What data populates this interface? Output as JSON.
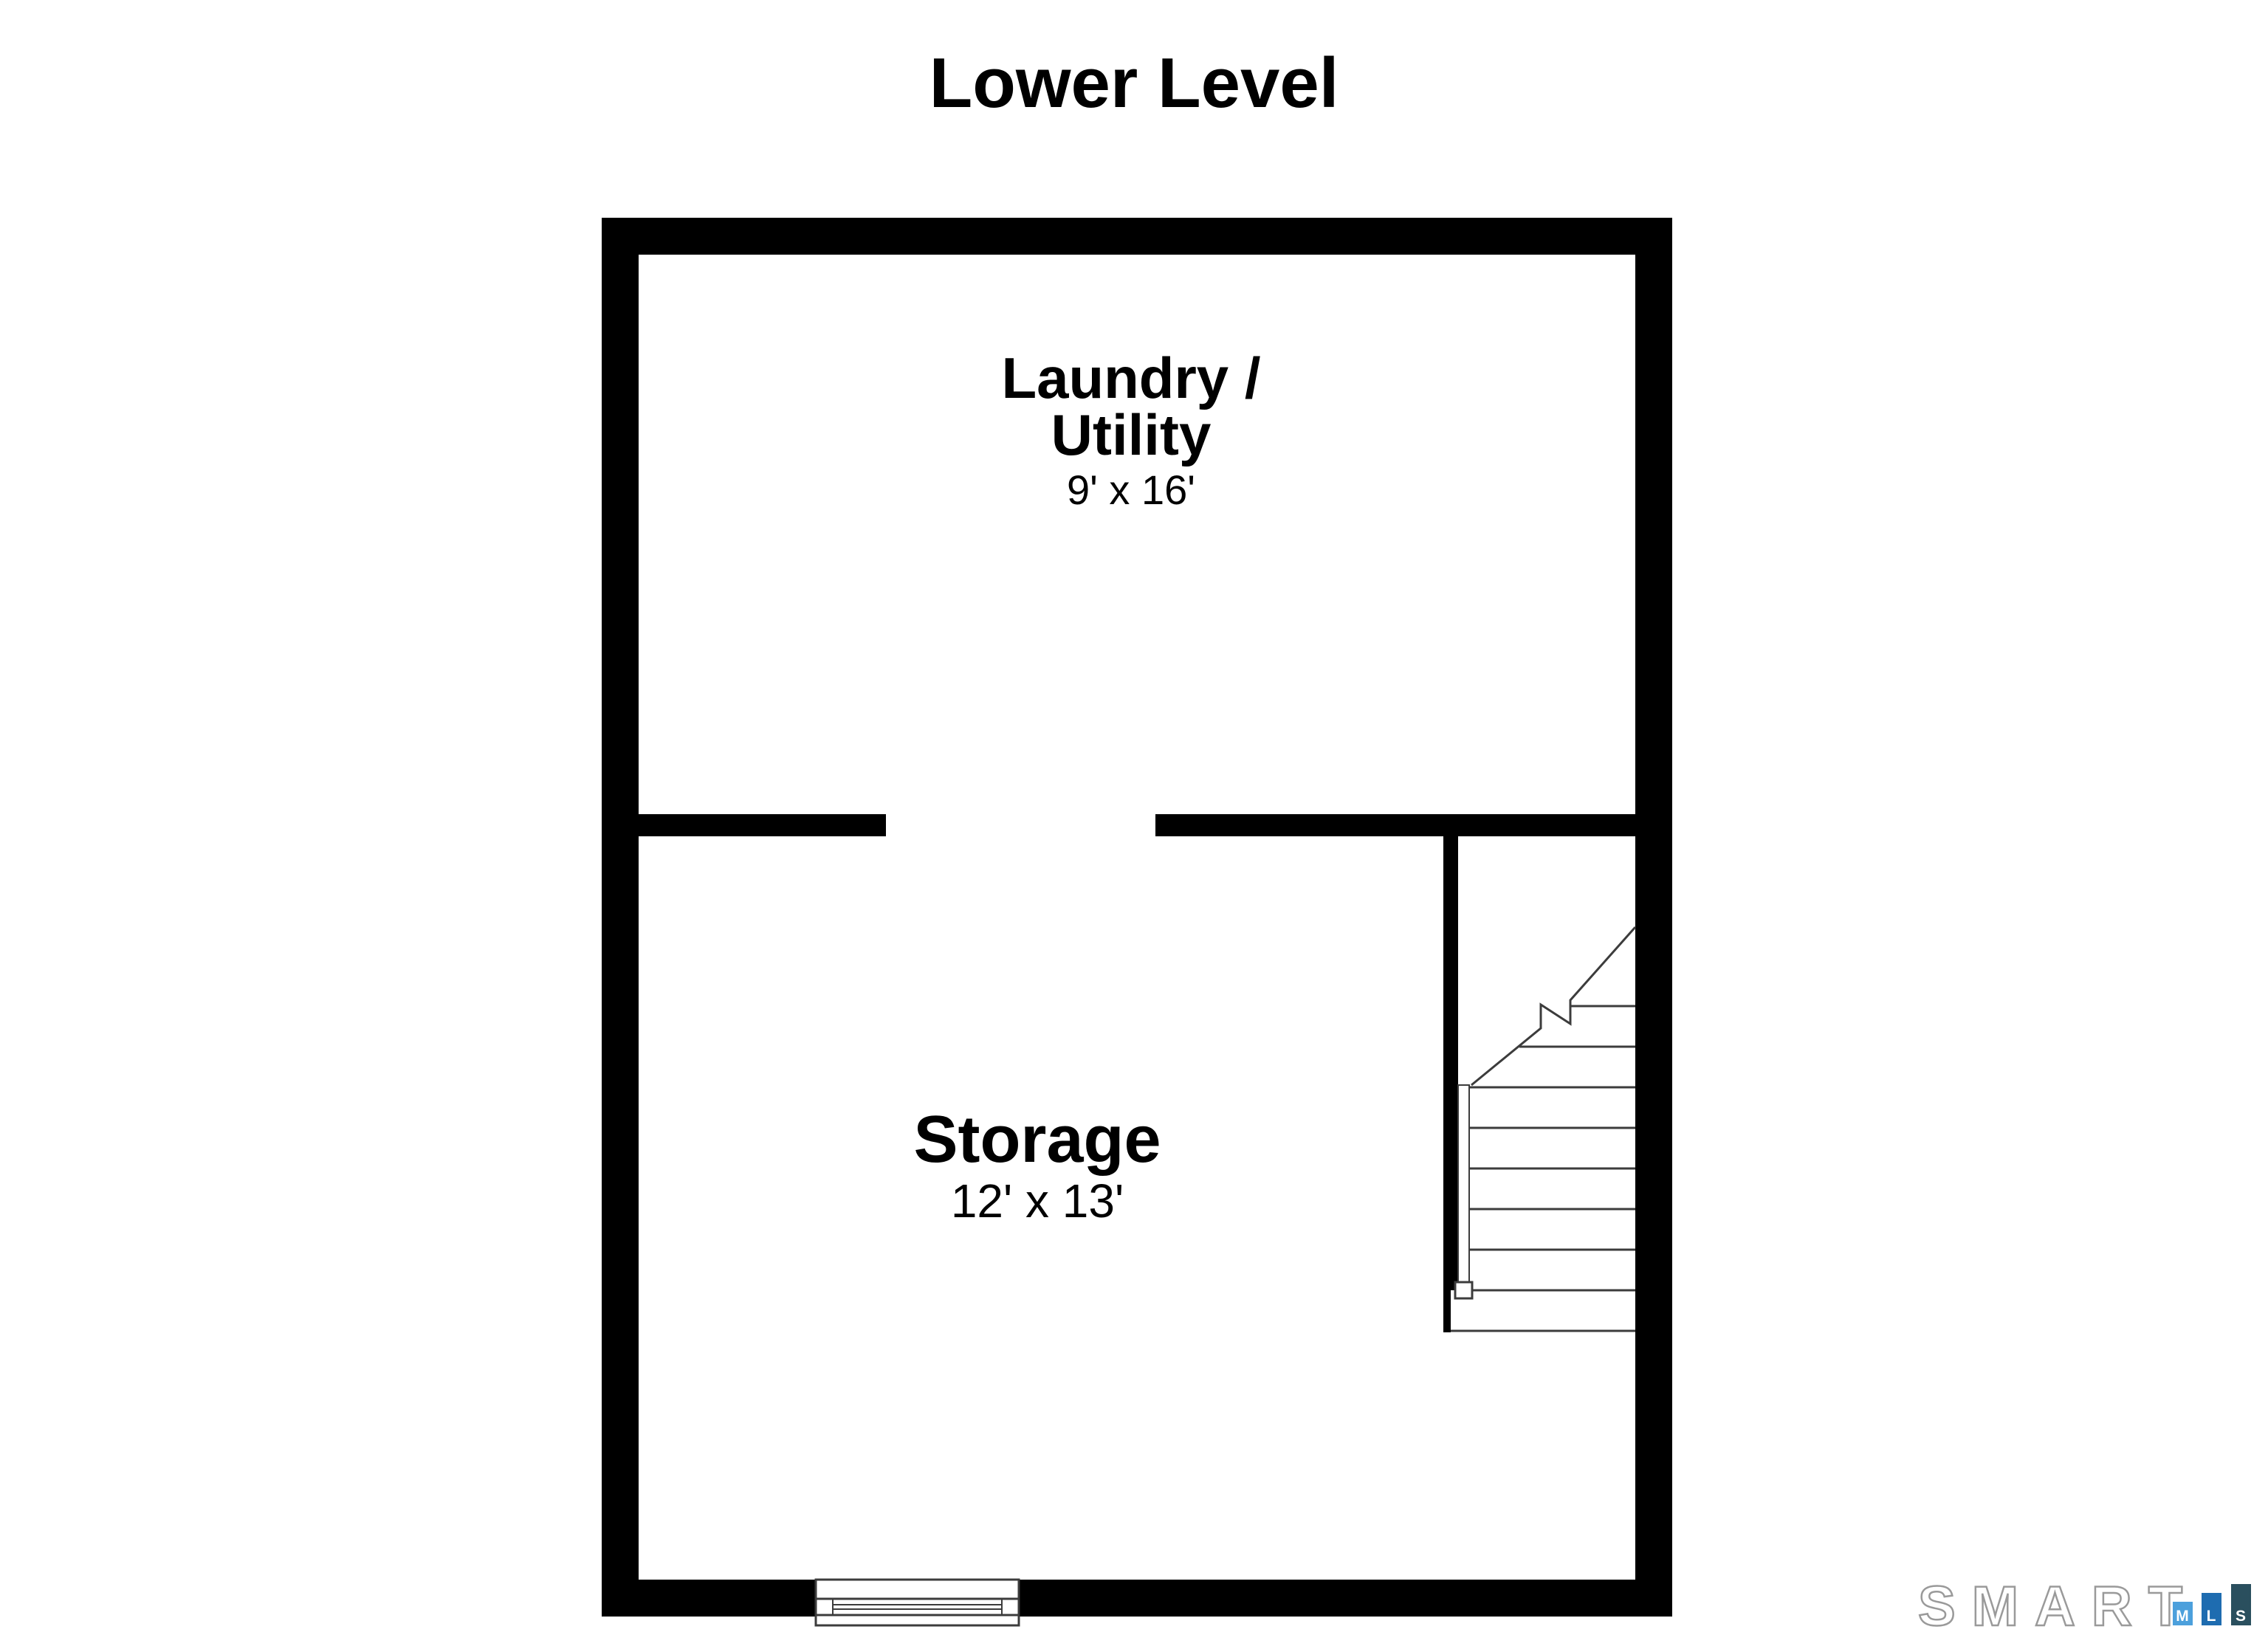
{
  "page": {
    "title": "Lower Level"
  },
  "rooms": {
    "laundry_utility": {
      "name_line_1": "Laundry /",
      "name_line_2": "Utility",
      "dimensions": "9' x 16'"
    },
    "storage": {
      "name": "Storage",
      "dimensions": "12' x 13'"
    }
  },
  "branding": {
    "logo_text": "SMART",
    "outline_color": "#9a9a9a",
    "letter_color": "#ffffff",
    "tiles": [
      {
        "letter": "M",
        "color": "#4CA0DC"
      },
      {
        "letter": "L",
        "color": "#1E6CB0"
      },
      {
        "letter": "S",
        "color": "#2A4F5E"
      }
    ]
  },
  "plan": {
    "wall_color": "#000000",
    "line_color": "#3c3c3c"
  }
}
